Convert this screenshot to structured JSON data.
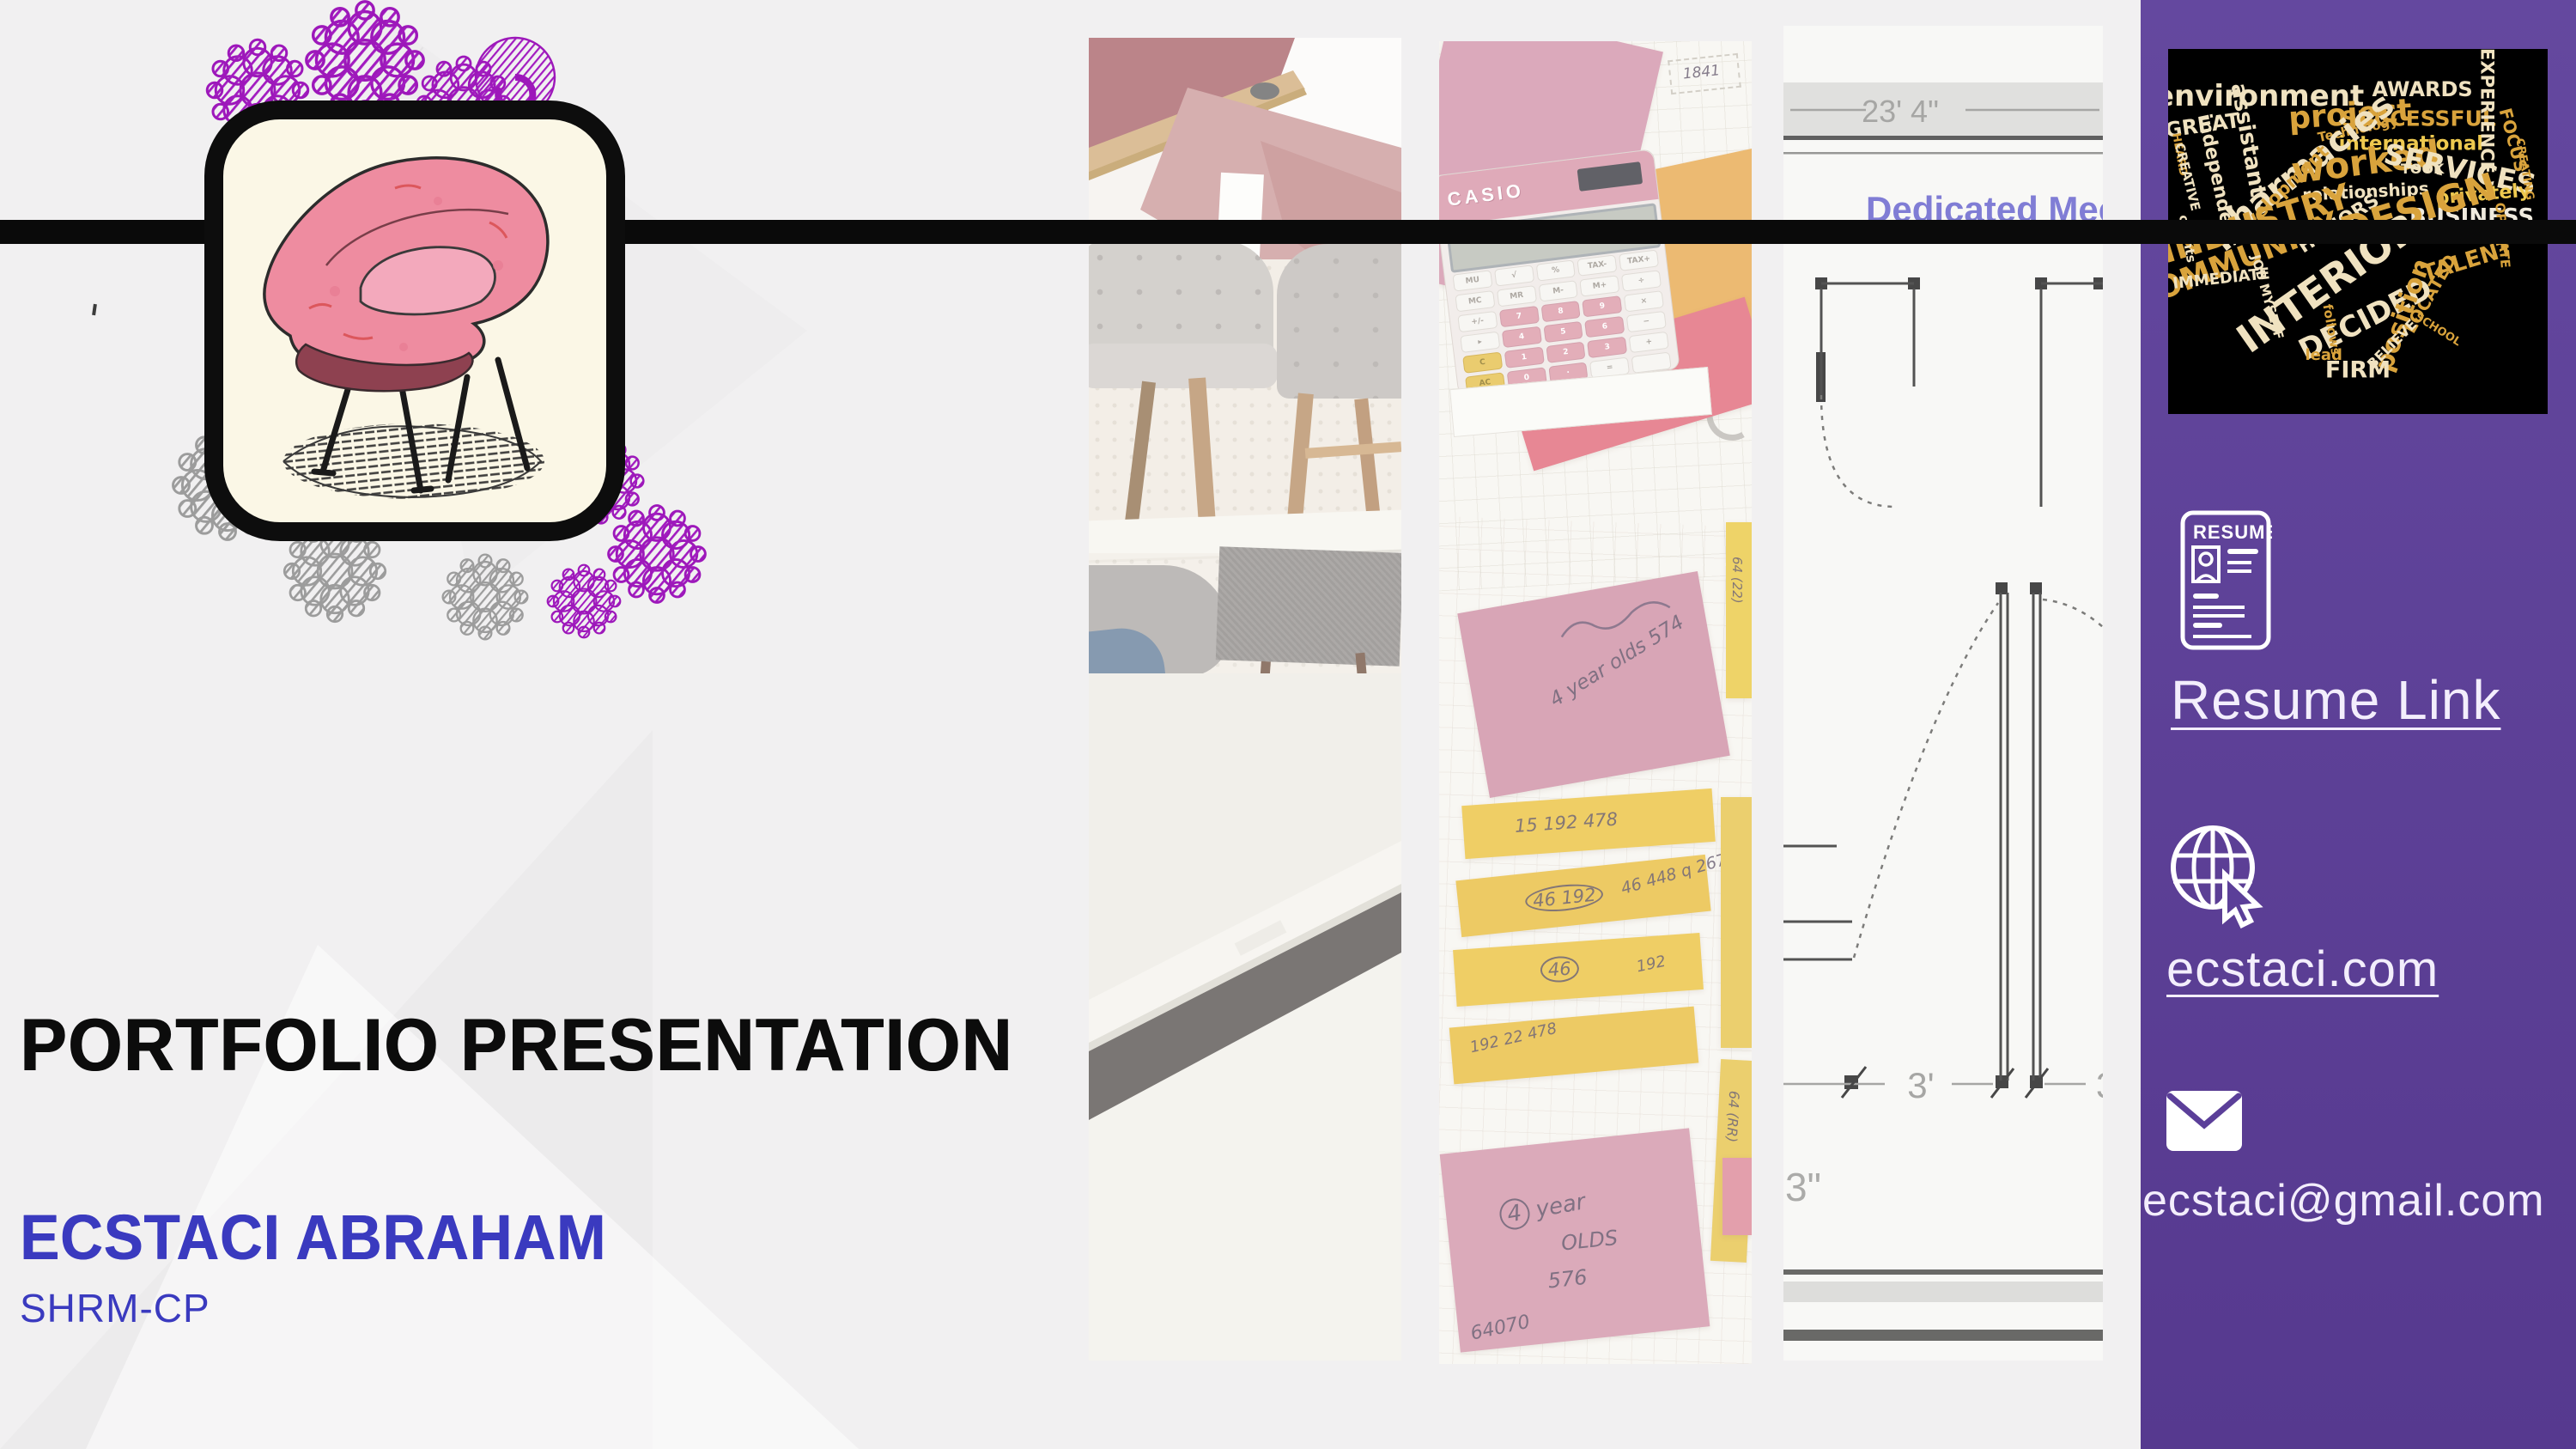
{
  "slide": {
    "title": "PORTFOLIO PRESENTATION",
    "name": "ECSTACI ABRAHAM",
    "credential": "SHRM-CP"
  },
  "colors": {
    "background": "#f1f0f1",
    "sidebar_purple": "#5b3f99",
    "accent_line_black": "#0a0a0a",
    "name_blue": "#3a3abf",
    "lace_purple": "#9d18ba",
    "lace_gray": "#9c9c9c"
  },
  "sidebar": {
    "links": {
      "resume": "Resume Link",
      "website": "ecstaci.com",
      "email": "ecstaci@gmail.com"
    },
    "resume_icon_label": "RESUME",
    "wordcloud": {
      "palette": {
        "cream": "#f0e2c0",
        "gold": "#d9a33c",
        "yellow": "#eec94f",
        "amber": "#c8892b",
        "white": "#efeadd"
      },
      "words": [
        {
          "t": "environment",
          "x": 24,
          "y": 13,
          "s": 34,
          "r": 0,
          "c": "cream"
        },
        {
          "t": "project",
          "x": 48,
          "y": 18,
          "s": 36,
          "r": -4,
          "c": "gold"
        },
        {
          "t": "AWARDS",
          "x": 67,
          "y": 11,
          "s": 24,
          "r": 0,
          "c": "cream"
        },
        {
          "t": "SUCCESSFUL",
          "x": 66,
          "y": 19,
          "s": 25,
          "r": 0,
          "c": "gold"
        },
        {
          "t": "international",
          "x": 64,
          "y": 26,
          "s": 23,
          "r": 0,
          "c": "yellow"
        },
        {
          "t": "EXPERIENCE",
          "x": 84,
          "y": 17,
          "s": 21,
          "r": 90,
          "c": "cream"
        },
        {
          "t": "FOCUS",
          "x": 91,
          "y": 25,
          "s": 20,
          "r": 75,
          "c": "gold"
        },
        {
          "t": "GREAT",
          "x": 9,
          "y": 21,
          "s": 24,
          "r": -8,
          "c": "cream"
        },
        {
          "t": "HEARD",
          "x": 3,
          "y": 29,
          "s": 13,
          "r": 80,
          "c": "gold"
        },
        {
          "t": "CREATIVE",
          "x": 5,
          "y": 35,
          "s": 15,
          "r": 76,
          "c": "cream"
        },
        {
          "t": "assistant",
          "x": 21,
          "y": 25,
          "s": 26,
          "r": 80,
          "c": "cream"
        },
        {
          "t": "independent",
          "x": 13,
          "y": 36,
          "s": 22,
          "r": 78,
          "c": "cream"
        },
        {
          "t": "Technology",
          "x": 50,
          "y": 22,
          "s": 15,
          "r": -12,
          "c": "gold"
        },
        {
          "t": "pharmacies",
          "x": 35,
          "y": 33,
          "s": 40,
          "r": -38,
          "c": "cream"
        },
        {
          "t": "worked",
          "x": 52,
          "y": 31,
          "s": 42,
          "r": -7,
          "c": "gold"
        },
        {
          "t": "TOOK",
          "x": 67,
          "y": 33,
          "s": 16,
          "r": 0,
          "c": "cream"
        },
        {
          "t": "SERVICES",
          "x": 77,
          "y": 33,
          "s": 33,
          "r": 12,
          "c": "cream"
        },
        {
          "t": "privately",
          "x": 83,
          "y": 40,
          "s": 22,
          "r": -5,
          "c": "yellow"
        },
        {
          "t": "BUSINESS",
          "x": 80,
          "y": 46,
          "s": 26,
          "r": 0,
          "c": "white"
        },
        {
          "t": "CREATING",
          "x": 94,
          "y": 33,
          "s": 13,
          "r": 80,
          "c": "gold"
        },
        {
          "t": "development",
          "x": 29,
          "y": 40,
          "s": 21,
          "r": -44,
          "c": "gold"
        },
        {
          "t": "relationships",
          "x": 52,
          "y": 39,
          "s": 20,
          "r": -3,
          "c": "cream"
        },
        {
          "t": "HONORS",
          "x": 45,
          "y": 48,
          "s": 22,
          "r": -33,
          "c": "cream"
        },
        {
          "t": "DESIGN",
          "x": 66,
          "y": 44,
          "s": 44,
          "r": -17,
          "c": "gold"
        },
        {
          "t": "INDUSTRY",
          "x": 23,
          "y": 48,
          "s": 40,
          "r": -17,
          "c": "gold"
        },
        {
          "t": "clients",
          "x": 5,
          "y": 52,
          "s": 15,
          "r": 80,
          "c": "cream"
        },
        {
          "t": "COMMUNITY",
          "x": 18,
          "y": 58,
          "s": 36,
          "r": -21,
          "c": "gold"
        },
        {
          "t": "OPERATE",
          "x": 88,
          "y": 51,
          "s": 15,
          "r": 85,
          "c": "gold"
        },
        {
          "t": "TALENT",
          "x": 79,
          "y": 58,
          "s": 26,
          "r": -17,
          "c": "gold"
        },
        {
          "t": "IMMEDIATE",
          "x": 14,
          "y": 63,
          "s": 18,
          "r": -6,
          "c": "cream"
        },
        {
          "t": "JOB MYSELF",
          "x": 26,
          "y": 68,
          "s": 15,
          "r": 74,
          "c": "cream"
        },
        {
          "t": "INTERIOR",
          "x": 42,
          "y": 64,
          "s": 46,
          "r": -35,
          "c": "cream"
        },
        {
          "t": "LOCATED",
          "x": 69,
          "y": 67,
          "s": 20,
          "r": -60,
          "c": "gold"
        },
        {
          "t": "DECIDED",
          "x": 52,
          "y": 74,
          "s": 34,
          "r": -27,
          "c": "cream"
        },
        {
          "t": "position",
          "x": 62,
          "y": 73,
          "s": 30,
          "r": -70,
          "c": "gold"
        },
        {
          "t": "BELIEVE",
          "x": 59,
          "y": 81,
          "s": 16,
          "r": -45,
          "c": "cream"
        },
        {
          "t": "follows",
          "x": 43,
          "y": 77,
          "s": 15,
          "r": 80,
          "c": "gold"
        },
        {
          "t": "SCHOOL",
          "x": 71,
          "y": 77,
          "s": 13,
          "r": 32,
          "c": "gold"
        },
        {
          "t": "lead",
          "x": 41,
          "y": 84,
          "s": 18,
          "r": 0,
          "c": "gold"
        },
        {
          "t": "FIRM",
          "x": 50,
          "y": 88,
          "s": 27,
          "r": 0,
          "c": "cream"
        }
      ]
    }
  },
  "strips": {
    "floorplan": {
      "dim_top": "23' 4\"",
      "room_label": "Dedicated Mee",
      "dim_a": "3'",
      "dim_b": "3\"",
      "dim_c": "3"
    },
    "notes": {
      "calculator": {
        "brand": "CASIO",
        "keys": [
          {
            "t": "MU",
            "k": "w"
          },
          {
            "t": "√",
            "k": "w"
          },
          {
            "t": "%",
            "k": "w"
          },
          {
            "t": "TAX-",
            "k": "w"
          },
          {
            "t": "TAX+",
            "k": "w"
          },
          {
            "t": "MC",
            "k": "w"
          },
          {
            "t": "MR",
            "k": "w"
          },
          {
            "t": "M-",
            "k": "w"
          },
          {
            "t": "M+",
            "k": "w"
          },
          {
            "t": "÷",
            "k": "w"
          },
          {
            "t": "+/-",
            "k": "w"
          },
          {
            "t": "7",
            "k": "n"
          },
          {
            "t": "8",
            "k": "n"
          },
          {
            "t": "9",
            "k": "n"
          },
          {
            "t": "×",
            "k": "w"
          },
          {
            "t": "▸",
            "k": "w"
          },
          {
            "t": "4",
            "k": "n"
          },
          {
            "t": "5",
            "k": "n"
          },
          {
            "t": "6",
            "k": "n"
          },
          {
            "t": "−",
            "k": "w"
          },
          {
            "t": "C",
            "k": "y"
          },
          {
            "t": "1",
            "k": "n"
          },
          {
            "t": "2",
            "k": "n"
          },
          {
            "t": "3",
            "k": "n"
          },
          {
            "t": "+",
            "k": "w"
          },
          {
            "t": "AC",
            "k": "y"
          },
          {
            "t": "0",
            "k": "n"
          },
          {
            "t": "·",
            "k": "n"
          },
          {
            "t": "=",
            "k": "w"
          },
          {
            "t": "",
            "k": "w"
          }
        ]
      },
      "annotations": [
        "1841",
        "20 192",
        "4 year olds 574",
        "64 (22)",
        "15  192   478",
        "46  448 q 267",
        "46   192",
        "192  22 478",
        "4 year OLDS 576",
        "64070",
        "64 (RR)"
      ]
    }
  }
}
